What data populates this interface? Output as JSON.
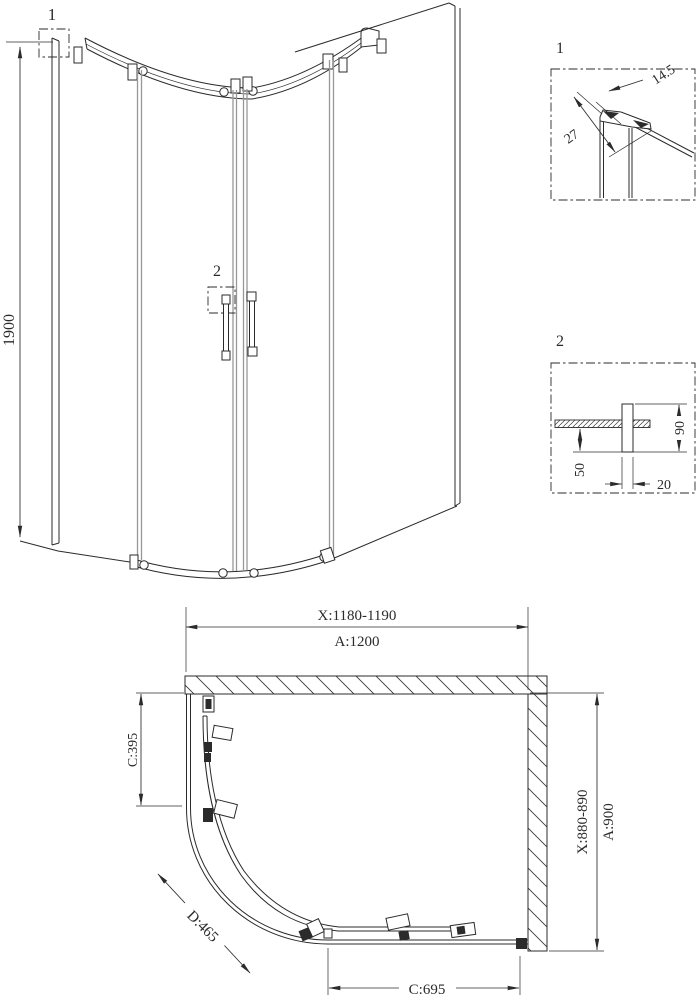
{
  "drawing": {
    "line_color": "#2b2b2b",
    "glass_line_color": "#979797",
    "elevation": {
      "callout_1": "1",
      "callout_2": "2",
      "dim_height": "1900"
    },
    "detail_1": {
      "label": "1",
      "dim_profile_width": "14.5",
      "dim_profile_depth": "27"
    },
    "detail_2": {
      "label": "2",
      "dim_handle_height": "90",
      "dim_handle_offset": "50",
      "dim_handle_width": "20"
    },
    "plan": {
      "dim_top_adjust": "X:1180-1190",
      "dim_top_overall": "A:1200",
      "dim_left_panel": "C:395",
      "dim_right_adjust": "X:880-890",
      "dim_right_overall": "A:900",
      "dim_diagonal": "D:465",
      "dim_bottom_panel": "C:695"
    }
  }
}
